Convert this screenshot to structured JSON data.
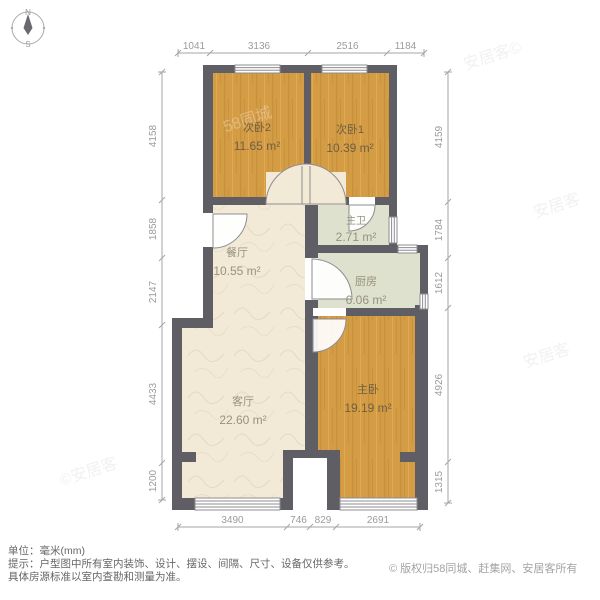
{
  "compass": {
    "north": "N",
    "south": "S"
  },
  "rooms": [
    {
      "name": "次卧2",
      "area": "11.65 m²"
    },
    {
      "name": "次卧1",
      "area": "10.39 m²"
    },
    {
      "name": "主卫",
      "area": "2.71 m²"
    },
    {
      "name": "餐厅",
      "area": "10.55 m²"
    },
    {
      "name": "厨房",
      "area": "6.06 m²"
    },
    {
      "name": "客厅",
      "area": "22.60 m²"
    },
    {
      "name": "主卧",
      "area": "19.19 m²"
    }
  ],
  "dimensions": {
    "top": [
      "1041",
      "3136",
      "2516",
      "1184"
    ],
    "left": [
      "4158",
      "1858",
      "2147",
      "4433",
      "1200"
    ],
    "right": [
      "4159",
      "1784",
      "1612",
      "4926",
      "1315"
    ],
    "bottom": [
      "3490",
      "746",
      "829",
      "2691"
    ]
  },
  "footer": {
    "unit_line": "单位：毫米(mm)",
    "tip_line1": "提示：户型图中所有室内装饰、设计、摆设、间隔、尺寸、设备仅供参考。",
    "tip_line2": "具体房源标准以室内查勘和测量为准。",
    "copyright": "© 版权归58同城、赶集网、安居客所有"
  },
  "watermarks": [
    "安居客©",
    "58同城",
    "安居客",
    "©安居客",
    "安居客"
  ],
  "colors": {
    "wall": "#5e5e64",
    "wood_floor": "#d59c46",
    "tan_floor": "#f2ead6",
    "green_floor": "#dde1cd",
    "dim_gray": "#9b9b9b"
  }
}
